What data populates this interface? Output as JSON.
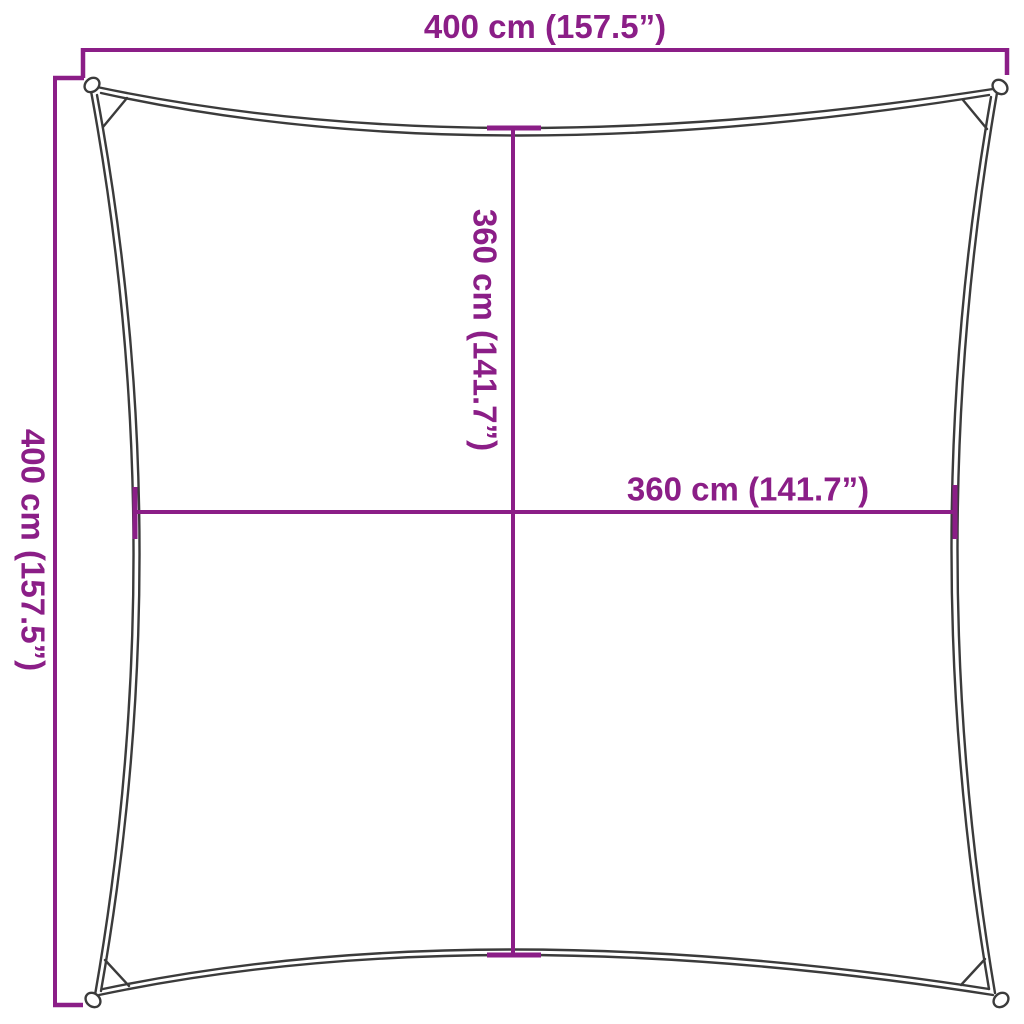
{
  "diagram": {
    "type": "product-dimension-drawing",
    "subject": "square shade sail",
    "outer_width_label": "400 cm (157.5”)",
    "outer_height_label": "400 cm (157.5”)",
    "inner_height_label": "360 cm (141.7”)",
    "inner_width_label": "360 cm (141.7”)",
    "colors": {
      "dimension_lines_and_text": "#8B1E87",
      "sail_outline": "#3B3B3B",
      "background": "#FFFFFF"
    }
  }
}
